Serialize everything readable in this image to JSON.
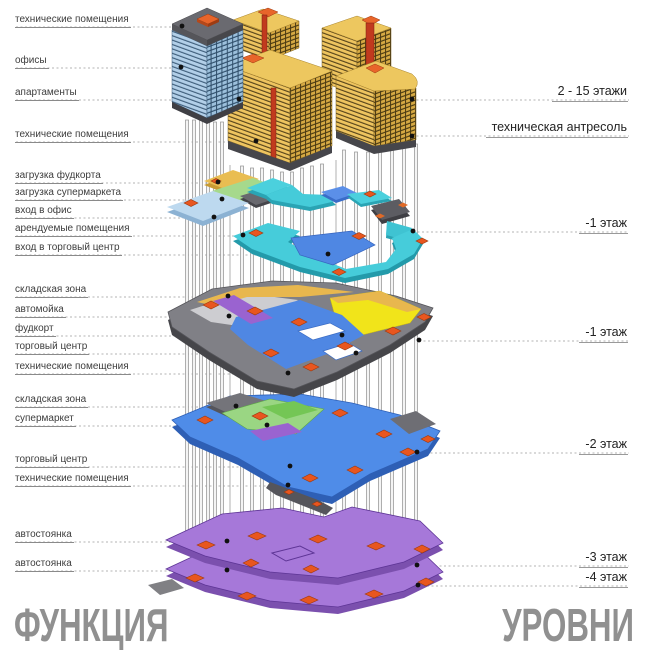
{
  "titles": {
    "function": "ФУНКЦИЯ",
    "levels": "УРОВНИ"
  },
  "function_labels": [
    "технические помещения",
    "офисы",
    "апартаменты",
    "технические помещения",
    "загрузка фудкорта",
    "загрузка супермаркета",
    "вход в офис",
    "арендуемые помещения",
    "вход в торговый центр",
    "складская зона",
    "автомойка",
    "фудкорт",
    "торговый центр",
    "технические помещения",
    "складская зона",
    "супермаркет",
    "торговый центр",
    "технические помещения",
    "автостоянка",
    "автостоянка"
  ],
  "level_labels": [
    "2 - 15 этажи",
    "техническая антресоль",
    "-1 этаж",
    "-1 этаж",
    "-2 этаж",
    "-3 этаж",
    "-4 этаж"
  ],
  "palette": {
    "offices_blue": "#b2cfe8",
    "apartments_yellow": "#eec45f",
    "technical_gray": "#6a6a70",
    "core_orange": "#e8652a",
    "entry_cyan": "#46ccda",
    "mall_blue": "#4f87e3",
    "foodcourt_yellow": "#f1e41a",
    "supermarket_green": "#9ad683",
    "parking_purple": "#a678d9",
    "leader_dot": "#111111"
  }
}
